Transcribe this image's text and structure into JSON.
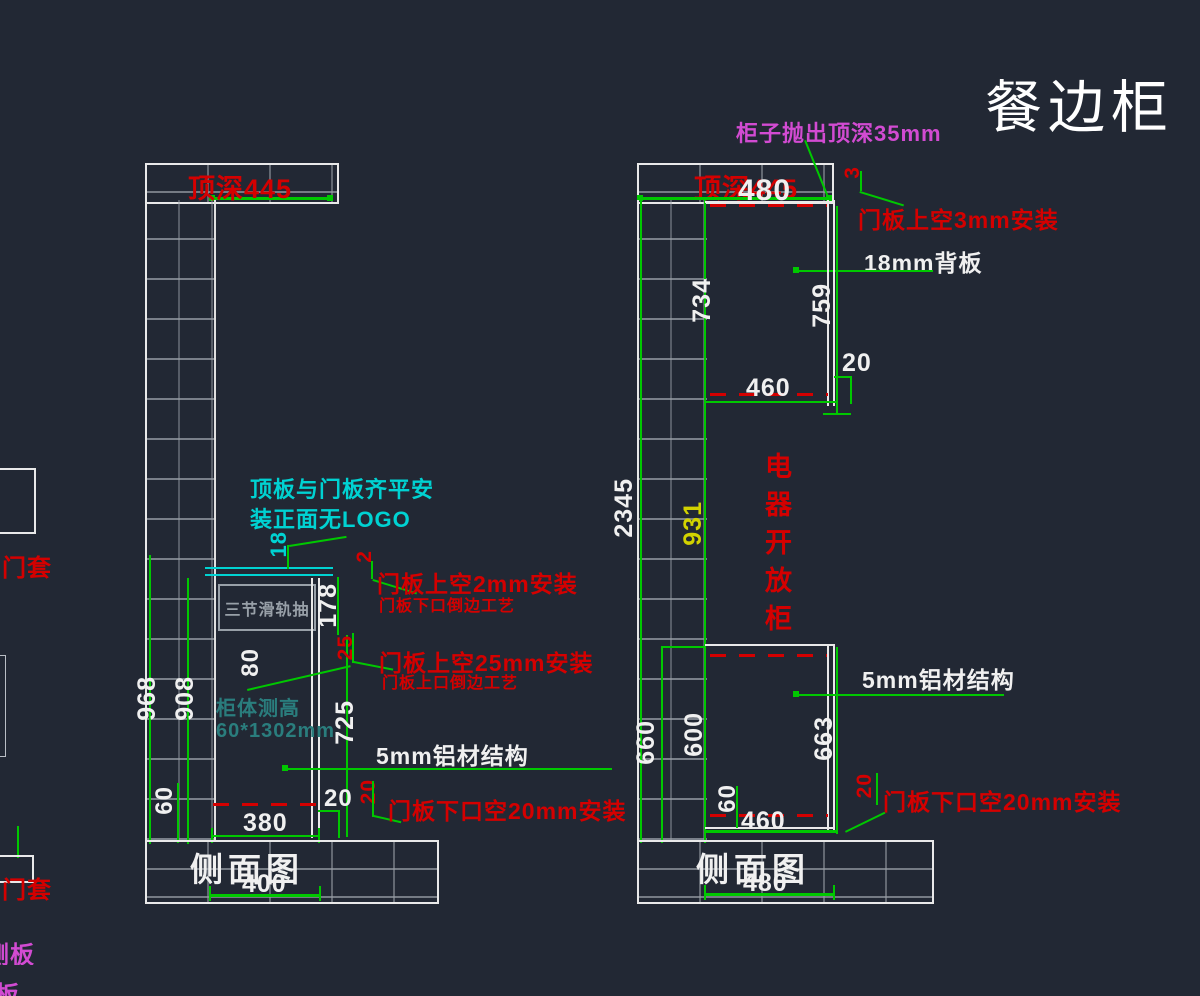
{
  "title": "餐边柜",
  "colors": {
    "background": "#222834",
    "dimension_green": "#00c800",
    "outline_white": "#e9e9e9",
    "annotation_red": "#d40000",
    "annotation_magenta": "#d24bd2",
    "annotation_cyan": "#00d2d2",
    "dimension_yellow": "#d2d200",
    "note_teal": "#2a7d7d",
    "hatch_gray": "#98a0a8"
  },
  "left_view": {
    "top_depth": "顶深445",
    "view_label": "侧面图",
    "base_width": "400",
    "dims": {
      "total_height": "968",
      "inner_height": "908",
      "drawer_zone": "178",
      "door_height": "725",
      "top_board": "18",
      "handle_up": "80",
      "bottom_rail": "60",
      "inner_width": "380",
      "bottom_gap": "20",
      "bottom_gap_red": "20",
      "top_gap_red": "2",
      "gap_25_red": "25"
    },
    "notes": {
      "drawer_slide": "三节滑轨抽",
      "flush_line1": "顶板与门板齐平安",
      "flush_line2": "装正面无LOGO",
      "body_size_line1": "柜体测高",
      "body_size_line2": "60*1302mm",
      "door_top_gap2": "门板上空2mm安装",
      "door_bottom_bevel": "门板下口倒边工艺",
      "door_top_gap25": "门板上空25mm安装",
      "door_top_bevel": "门板上口倒边工艺",
      "aluminum": "5mm铝材结构",
      "door_bottom_gap": "门板下口空20mm安装"
    }
  },
  "right_view": {
    "top_depth": "顶深445",
    "top_width": "480",
    "view_label": "侧面图",
    "base_width": "480",
    "cabinet_label": "电器开放柜",
    "dims": {
      "total_height": "2345",
      "middle_height": "931",
      "upper_height": "734",
      "upper_door": "759",
      "upper_width": "460",
      "upper_gap": "20",
      "top_gap_red": "3",
      "lower_left": "660",
      "lower_inner": "600",
      "lower_door": "663",
      "lower_rail": "60",
      "lower_width": "460",
      "bottom_gap_red": "20"
    },
    "notes": {
      "top_overhang": "柜子抛出顶深35mm",
      "door_top_gap3": "门板上空3mm安装",
      "back_panel": "18mm背板",
      "aluminum": "5mm铝材结构",
      "door_bottom_gap": "门板下口空20mm安装"
    }
  },
  "edge_labels": {
    "door_frame_1": "门套",
    "door_frame_2": "门套",
    "side_panel": "侧板",
    "partial": "板"
  }
}
